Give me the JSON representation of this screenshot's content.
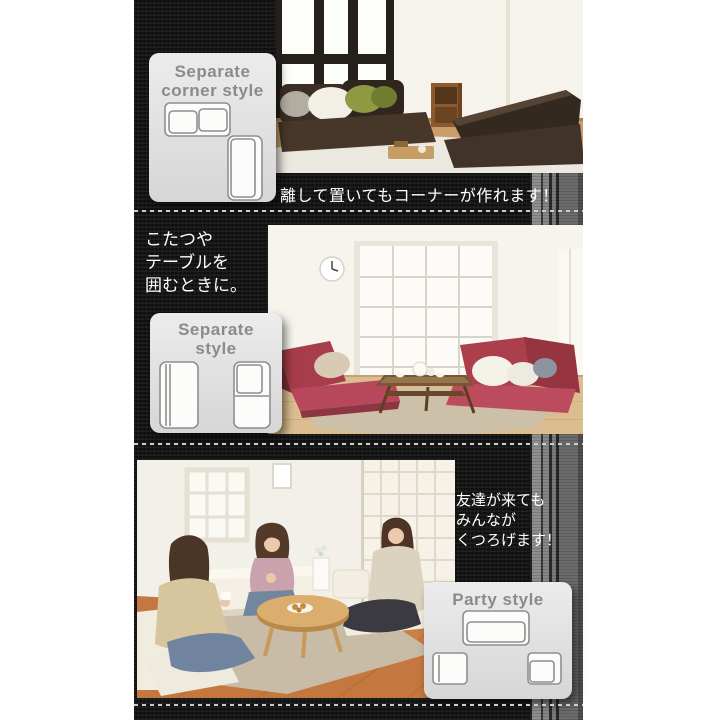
{
  "theme": {
    "page_bg": "#ffffff",
    "fabric_black": "#161616",
    "stripe_light_gray": "#8e8e8e",
    "stripe_mid_gray": "#6b6b6b",
    "badge_bg": "#e2e2e2",
    "badge_text_color": "#8b8b8b",
    "note_text_color": "#ffffff",
    "dash_color": "#cccccc"
  },
  "sections": [
    {
      "name": "separate-corner-style",
      "badge": {
        "line1": "Separate",
        "line2": "corner style"
      },
      "caption": "離して置いてもコーナーが作れます！"
    },
    {
      "name": "separate-style",
      "note": [
        "こたつや",
        "テーブルを",
        "囲むときに。"
      ],
      "badge": {
        "line1": "Separate",
        "line2": "style"
      }
    },
    {
      "name": "party-style",
      "note": [
        "友達が来ても",
        "みんなが",
        "くつろげます！"
      ],
      "badge": {
        "line1": "Party style"
      }
    }
  ]
}
